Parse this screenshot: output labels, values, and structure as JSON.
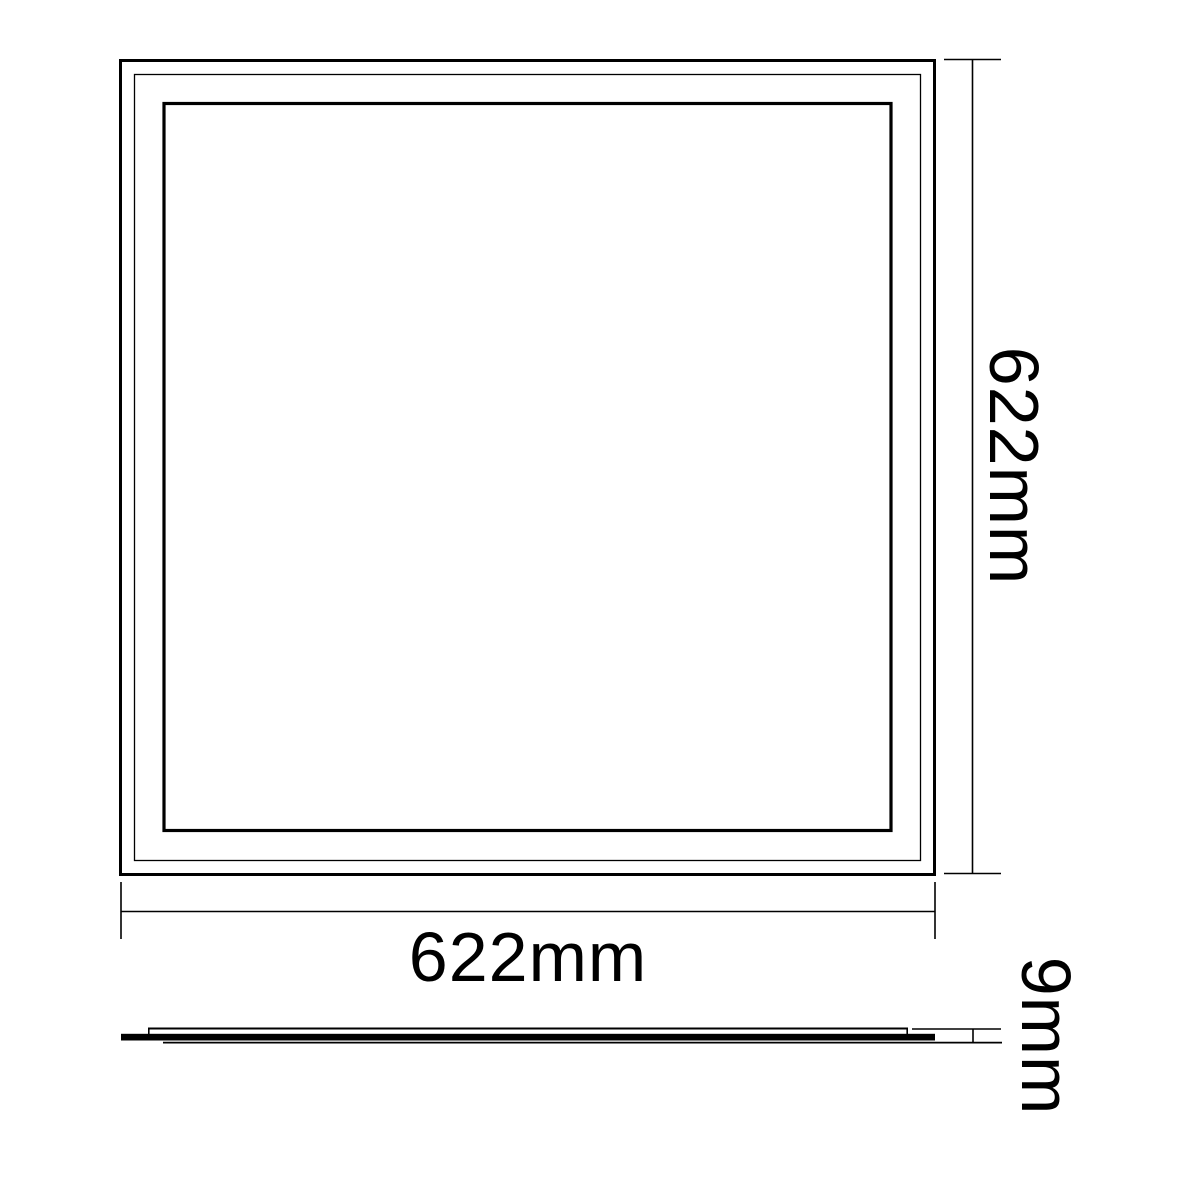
{
  "page": {
    "background_color": "#ffffff",
    "line_color": "#000000"
  },
  "drawing": {
    "dimensions": {
      "width": {
        "label": "622mm",
        "value": 622,
        "unit": "mm"
      },
      "height": {
        "label": "622mm",
        "value": 622,
        "unit": "mm"
      },
      "thickness": {
        "label": "9mm",
        "value": 9,
        "unit": "mm"
      }
    }
  }
}
